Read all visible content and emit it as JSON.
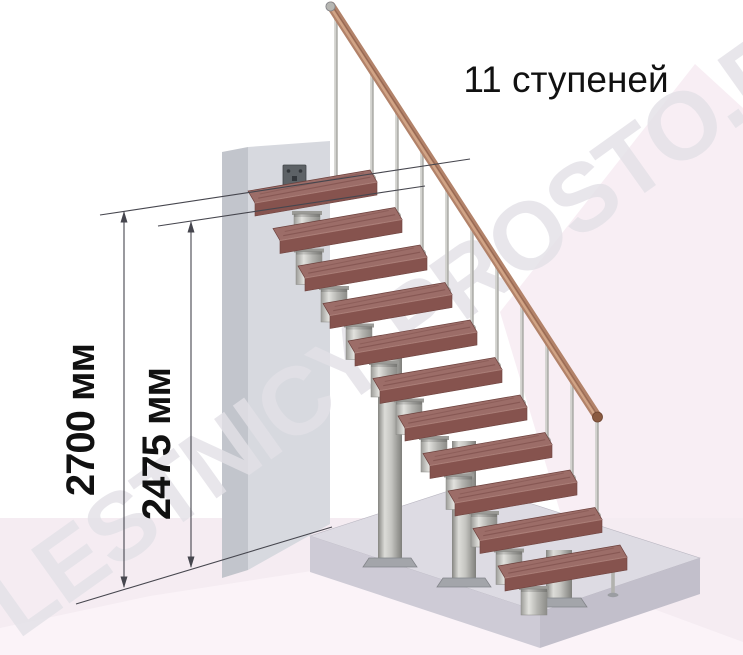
{
  "title": {
    "text": "11 ступеней"
  },
  "watermark": {
    "text": "LESTNICY-PROSTO.RU"
  },
  "dimensions": [
    {
      "id": "floor-to-floor-height",
      "label": "2700 мм",
      "value_mm": 2700
    },
    {
      "id": "stair-rise-height",
      "label": "2475 мм",
      "value_mm": 2475
    }
  ],
  "stair": {
    "steps_count": 11,
    "type": "modular-staircase",
    "has_handrail": true
  },
  "colors": {
    "text_color": "#111111",
    "dim_color": "#46464e",
    "watermark_color": "#e3e1e7",
    "floor": "#f5ecf2",
    "floor_light": "#fbf5f9",
    "backdrop": "#f8eef4",
    "wall_front": "#d7d9df",
    "wall_side": "#c2c5cc",
    "slab_top": "#dddbe3",
    "slab_left": "#cecbd6",
    "slab_right": "#c2bfcb",
    "tread_top": "#9c6d68",
    "tread_front": "#86534e",
    "tread_end": "#7a4944",
    "tread_edge": "#6b3f3b",
    "metal_light": "#dcdcd8",
    "metal_mid": "#b2b2ae",
    "metal_dark": "#868682",
    "rail": "#b28269",
    "rail_hi": "#d4a78a",
    "rail_dark": "#7d4f3c"
  }
}
